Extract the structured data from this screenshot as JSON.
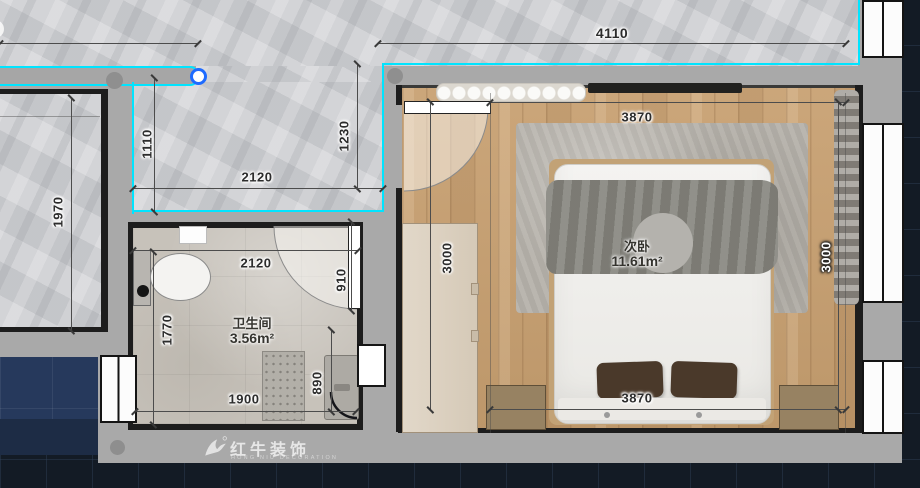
{
  "colors": {
    "accent_cyan": "#00E4FF",
    "grip_blue": "#1E6BFF",
    "wall_gray": "#A9A9A9",
    "wood_floor": "#C6A075",
    "marble_floor": "#CDCED1",
    "exterior_navy": "#26395C",
    "cad_background": "#131B25"
  },
  "rooms": {
    "bedroom": {
      "name": "次卧",
      "area": "11.61m²"
    },
    "bathroom": {
      "name": "卫生间",
      "area": "3.56m²"
    }
  },
  "dimensions": {
    "overall_top": "4110",
    "left_room": "1970",
    "hall_left": "1110",
    "hall_right": "1230",
    "hall_width": "2120",
    "bath_top_width": "2120",
    "bath_door": "910",
    "bath_left_height": "1770",
    "bath_bottom_width": "1900",
    "bath_shower_height": "890",
    "bedroom_top_width": "3870",
    "bedroom_bottom_width": "3870",
    "bedroom_left_height": "3000",
    "bedroom_right_height": "3000"
  },
  "watermark": {
    "brand": "红牛装饰",
    "tagline": "HONG NIU DECORATION"
  }
}
